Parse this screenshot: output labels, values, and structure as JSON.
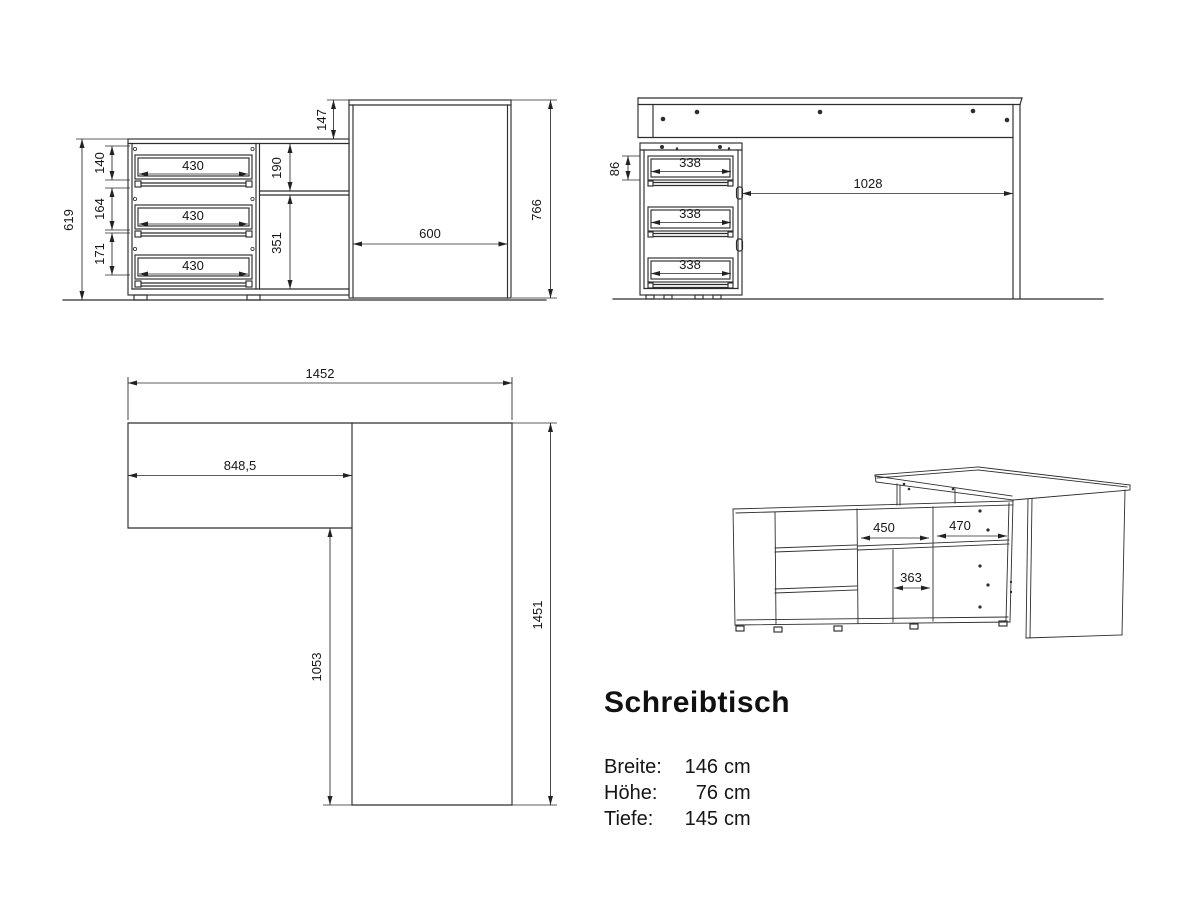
{
  "page": {
    "background": "#ffffff",
    "ink": "#2d2d2d"
  },
  "title_block": {
    "title": "Schreibtisch",
    "specs": [
      {
        "label": "Breite:",
        "value": "146",
        "unit": "cm"
      },
      {
        "label": "Höhe:",
        "value": "76",
        "unit": "cm"
      },
      {
        "label": "Tiefe:",
        "value": "145",
        "unit": "cm"
      }
    ]
  },
  "views": {
    "side_elevation": {
      "dims": {
        "total_height": "766",
        "desk_top_drop": "147",
        "cabinet_height": "619",
        "drawer1_height": "140",
        "drawer2_height": "164",
        "drawer3_height": "171",
        "drawer_width": "430",
        "upper_bay_height": "190",
        "lower_bay_height": "351",
        "desk_depth": "600"
      }
    },
    "front_elevation": {
      "dims": {
        "drawer_face": "86",
        "drawer_width": "338",
        "knee_space": "1028"
      }
    },
    "plan_view": {
      "dims": {
        "total_width": "1452",
        "return_length": "848,5",
        "side_clear": "1053",
        "total_depth": "1451"
      }
    },
    "perspective_view": {
      "dims": {
        "left_bay": "450",
        "right_bay": "470",
        "bottom_bay": "363"
      }
    }
  }
}
